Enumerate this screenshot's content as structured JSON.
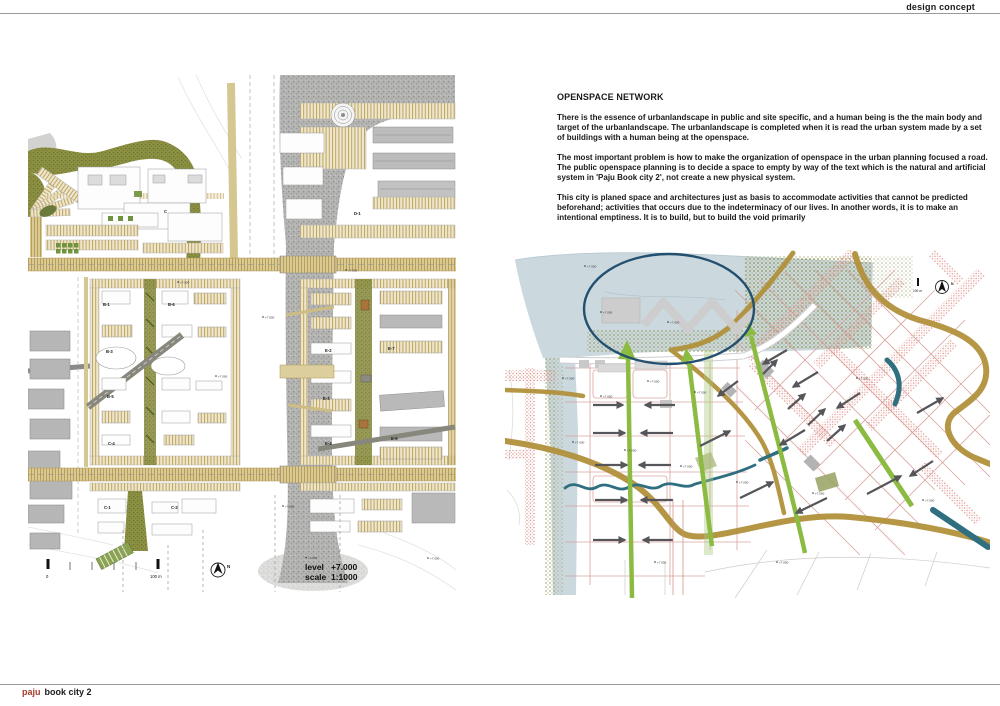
{
  "page": {
    "header_title": "design concept",
    "footer": {
      "brand": "paju",
      "rest": "book city 2"
    }
  },
  "text_panel": {
    "heading": "OPENSPACE NETWORK",
    "paragraphs": [
      "There is the essence of urbanlandscape in public and site specific, and a human being is the the main body and target of the urbanlandscape.  The urbanlandscape is completed when it is read the urban system made by a set of buildings with a human being at the openspace.",
      "The most important problem is how to make the organization of openspace in the urban planning focused a road. The public openspace planning is to decide a space to empty by way of the text which is the natural and artificial system in 'Paju Book city 2', not create a new physical system.",
      "This city is planed space and architectures just as basis to accommodate activities that cannot be predicted beforehand; activities that occurs due to the indeterminacy of our lives. In another words, it is to make an intentional emptiness. It is to build, but to build the void primarily"
    ]
  },
  "left_map": {
    "legend": {
      "level_label": "level",
      "level_value": "+7.000",
      "scale_label": "scale",
      "scale_value": "1:1000"
    },
    "scalebar": {
      "start": "0",
      "end": "100 m"
    },
    "north_label": "N",
    "spot_label": "+7.000",
    "blocks": {
      "c": "C",
      "d1": "D-1",
      "b1": "B-1",
      "b6": "B-6",
      "b3": "B-3",
      "b5": "B-5",
      "c4": "C-4",
      "c1": "C-1",
      "c2": "C-2",
      "e2": "E-2",
      "e7": "E-7",
      "e3": "E-3",
      "e4": "E-4",
      "e6": "E-6"
    }
  },
  "right_diagram": {
    "scalebar_end": "100 m",
    "north_label": "N",
    "spot_label": "+7.000"
  },
  "colors": {
    "brand_red": "#a63a2c",
    "olive": "#8b8f41",
    "road_tan": "#cdbb80",
    "river_gray": "#b4b4b2",
    "water_blue": "#cbd8de",
    "ellipse_navy": "#24506f",
    "arrow_green": "#8cbb42",
    "arrow_gray": "#56565a",
    "road_ochre": "#b2913c",
    "stream_teal": "#2f6f80",
    "hatch_pink": "#e09a93"
  }
}
